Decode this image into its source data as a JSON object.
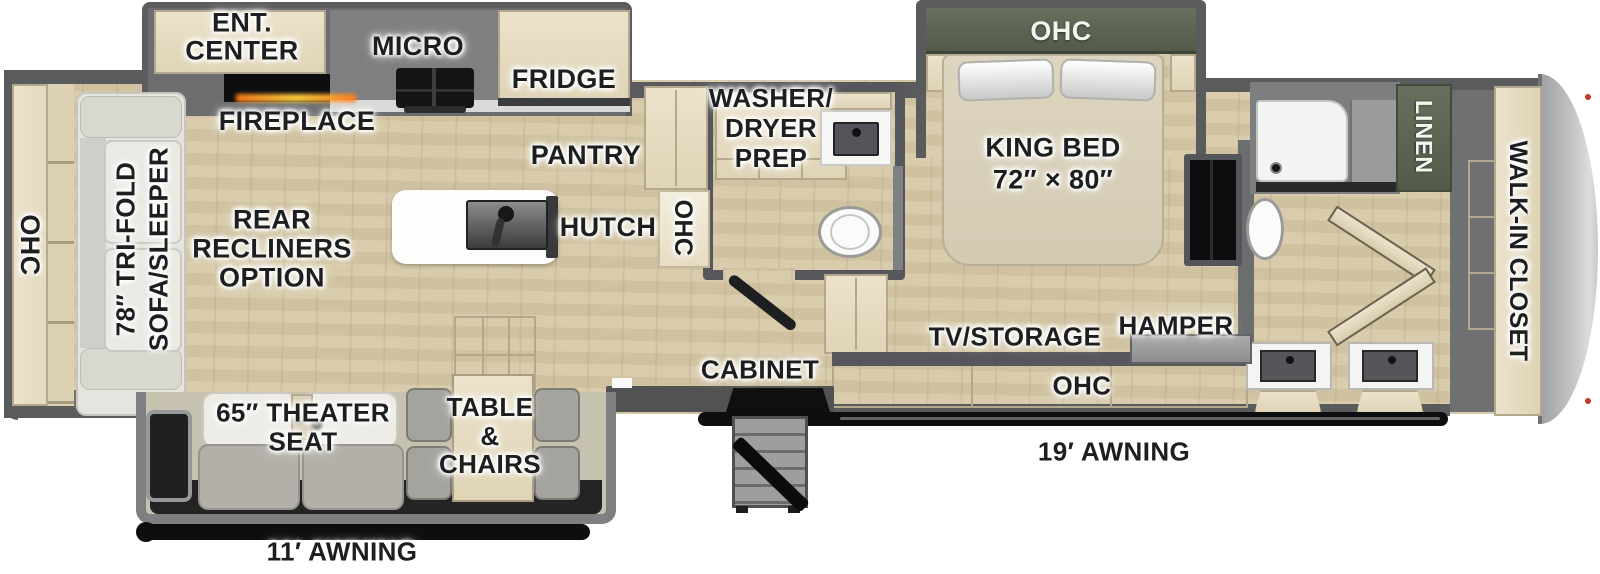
{
  "title": "RV fifth-wheel floor plan",
  "colors": {
    "wall": "#595b5d",
    "slide_wall": "#7d7f81",
    "floor_wood": "#d6c9a7",
    "cabinet_wood": "#e7ddc4",
    "cabinet_green": "#5a6253",
    "sofa_gray": "#e5e4de",
    "seat_gray": "#b2b0a9",
    "front_cap_gray": "#b7b9bb",
    "awning_black": "#0d0e10",
    "fireplace_glow": "#ff9a2a",
    "label_text": "#1d1e1f"
  },
  "labels": {
    "ent_center": [
      "ENT.",
      "CENTER"
    ],
    "micro": "MICRO",
    "fridge": "FRIDGE",
    "fireplace": "FIREPLACE",
    "pantry": "PANTRY",
    "rear_ohc": "OHC",
    "sofa": [
      "78″ TRI-FOLD",
      "SOFA/SLEEPER"
    ],
    "recliners": [
      "REAR",
      "RECLINERS",
      "OPTION"
    ],
    "hutch": "HUTCH",
    "mid_ohc": "OHC",
    "washer_dryer": [
      "WASHER/",
      "DRYER",
      "PREP"
    ],
    "king_bed": [
      "KING BED",
      "72″ × 80″"
    ],
    "bed_ohc": "OHC",
    "linen": "LINEN",
    "walk_in_closet": "WALK-IN CLOSET",
    "tv_storage": "TV/STORAGE",
    "hamper": "HAMPER",
    "bottom_ohc": "OHC",
    "cabinet": "CABINET",
    "theater_seat": [
      "65″ THEATER",
      "SEAT"
    ],
    "table_chairs": [
      "TABLE",
      "&",
      "CHAIRS"
    ],
    "awning_19": "19′ AWNING",
    "awning_11": "11′ AWNING"
  }
}
